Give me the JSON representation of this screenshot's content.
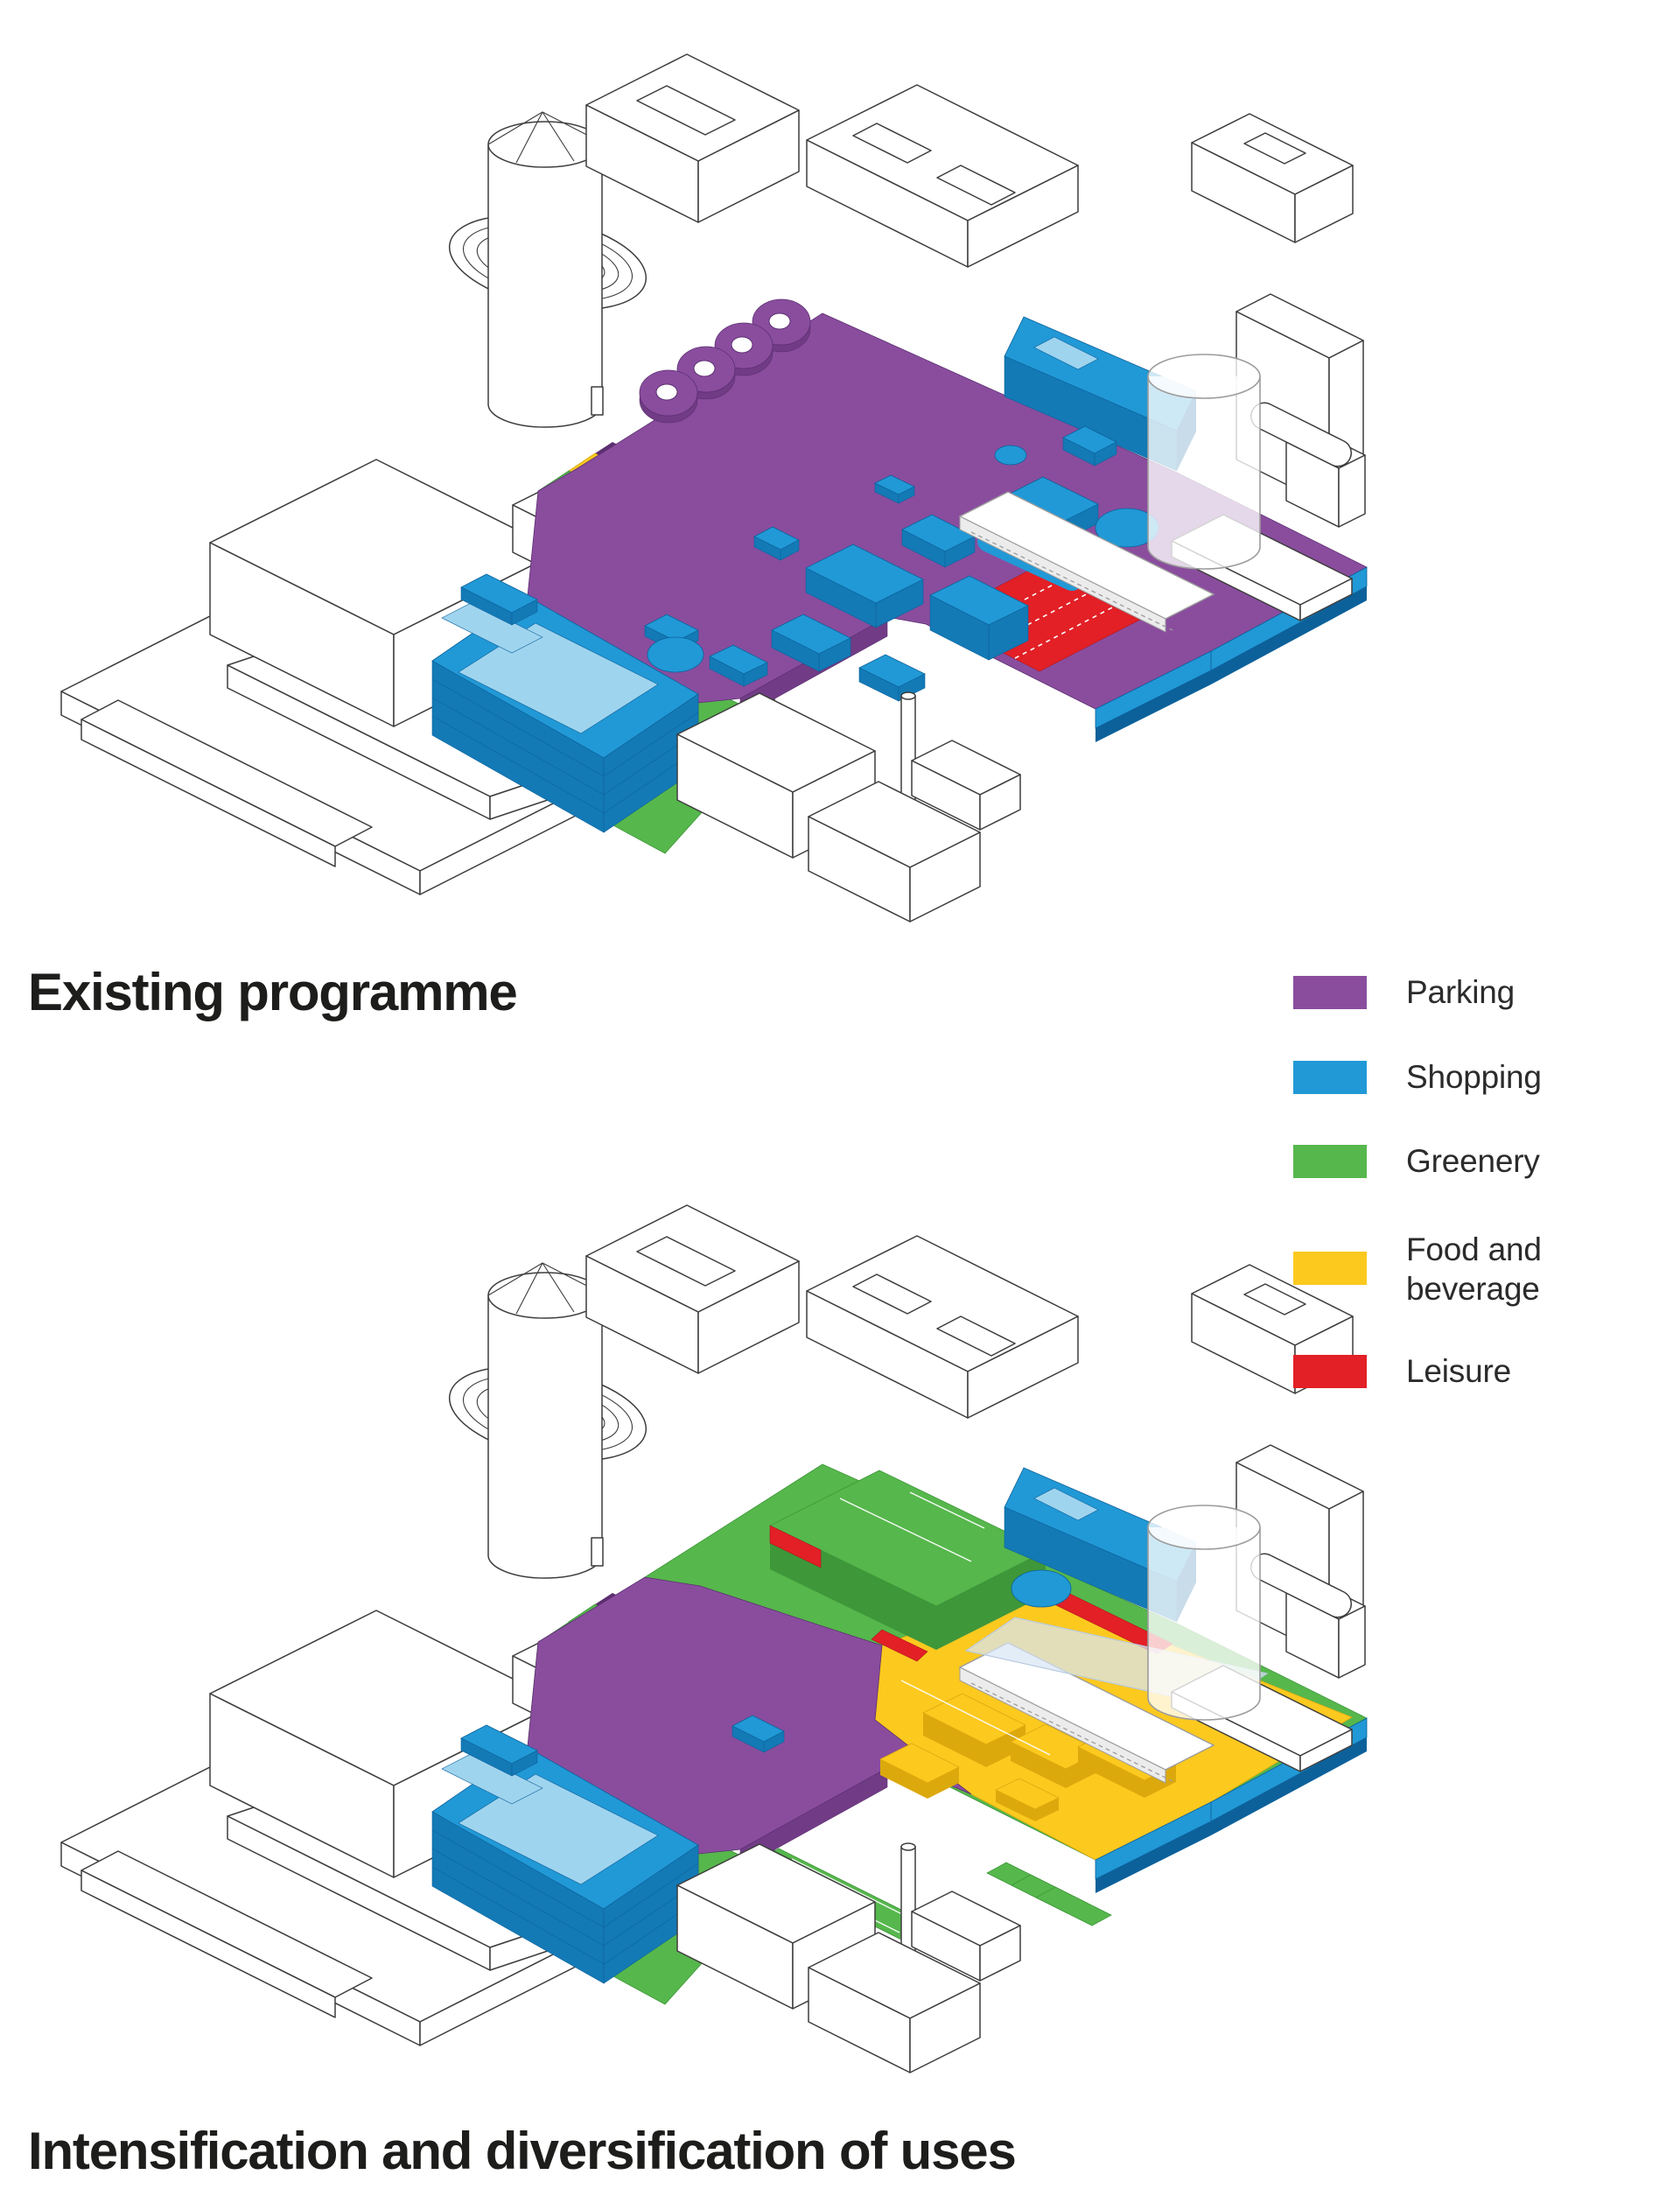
{
  "page": {
    "background": "#ffffff",
    "kind": "axonometric-programme-diagram"
  },
  "palette": {
    "parking": "#8A4D9E",
    "parking_side": "#713C85",
    "parking_dark": "#5C2F71",
    "shopping": "#2199D6",
    "shopping_side": "#137AB6",
    "shopping_dark": "#0D619A",
    "greenery": "#56B74C",
    "greenery_side": "#3E9739",
    "food": "#FCC91F",
    "food_side": "#DCA90D",
    "leisure": "#E22026",
    "leisure_side": "#AE171C",
    "glass": "#D8E6F5",
    "outline": "#3D3D3D",
    "outline_light": "#9C9C9C",
    "text": "#1D1D1B"
  },
  "sections": [
    {
      "id": "existing",
      "title": "Existing programme"
    },
    {
      "id": "proposed",
      "title": "Intensification and diversification of uses"
    }
  ],
  "legend": {
    "items": [
      {
        "label": "Parking",
        "color": "parking"
      },
      {
        "label": "Shopping",
        "color": "shopping"
      },
      {
        "label": "Greenery",
        "color": "greenery"
      },
      {
        "label": "Food and\nbeverage",
        "color": "food"
      },
      {
        "label": "Leisure",
        "color": "leisure"
      }
    ]
  }
}
